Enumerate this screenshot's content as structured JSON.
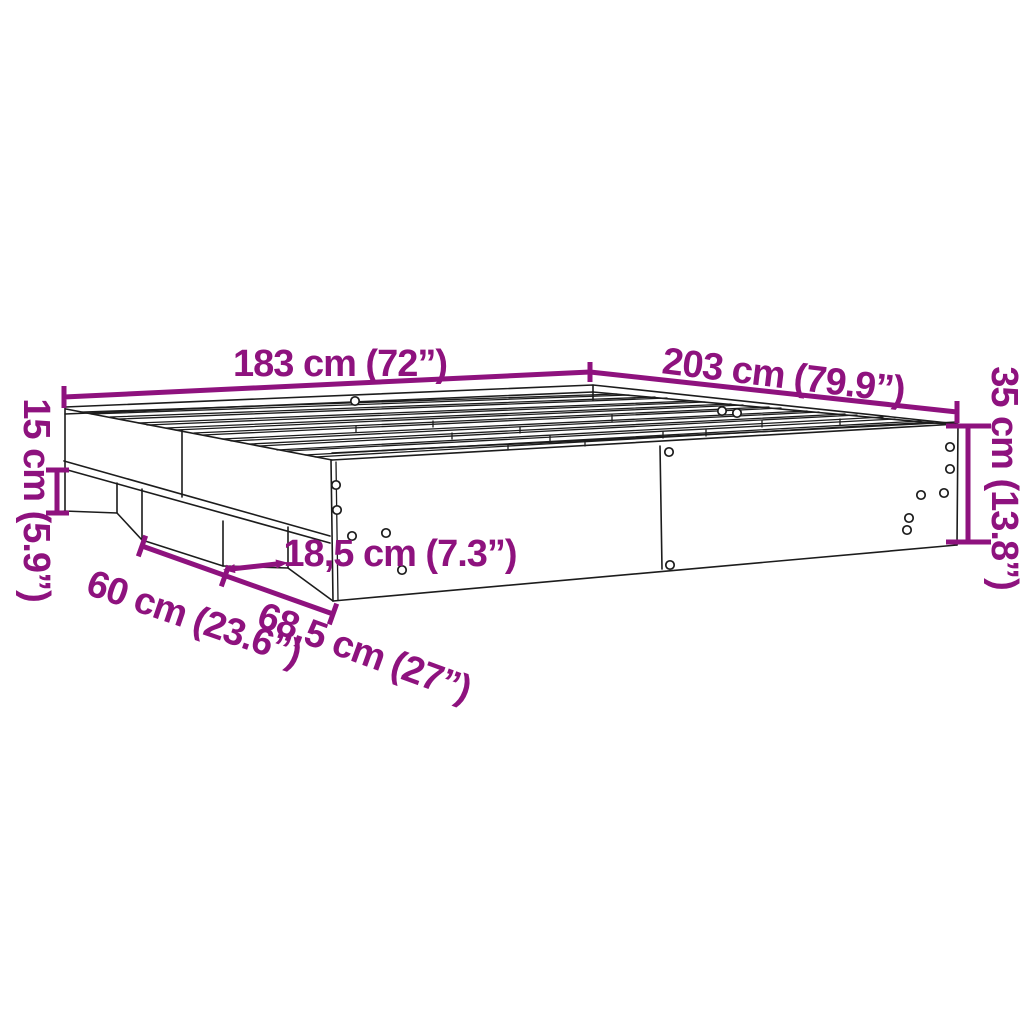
{
  "diagram": {
    "kind": "product-dimension-diagram",
    "subject": "bed-frame-with-slatted-base",
    "colors": {
      "accent": "#8E127E",
      "line": "#1c1c1c",
      "background": "#ffffff"
    },
    "dimensions": [
      {
        "id": "width",
        "label": "183 cm (72”)"
      },
      {
        "id": "length",
        "label": "203 cm (79.9”)"
      },
      {
        "id": "height",
        "label": "35 cm (13.8”)"
      },
      {
        "id": "base-height",
        "label": "15 cm (5.9”)"
      },
      {
        "id": "notch-width",
        "label": "18,5 cm (7.3”)"
      },
      {
        "id": "foot-width",
        "label": "60 cm (23.6”)"
      },
      {
        "id": "foot-spacing",
        "label": "68,5 cm (27”)"
      }
    ]
  }
}
